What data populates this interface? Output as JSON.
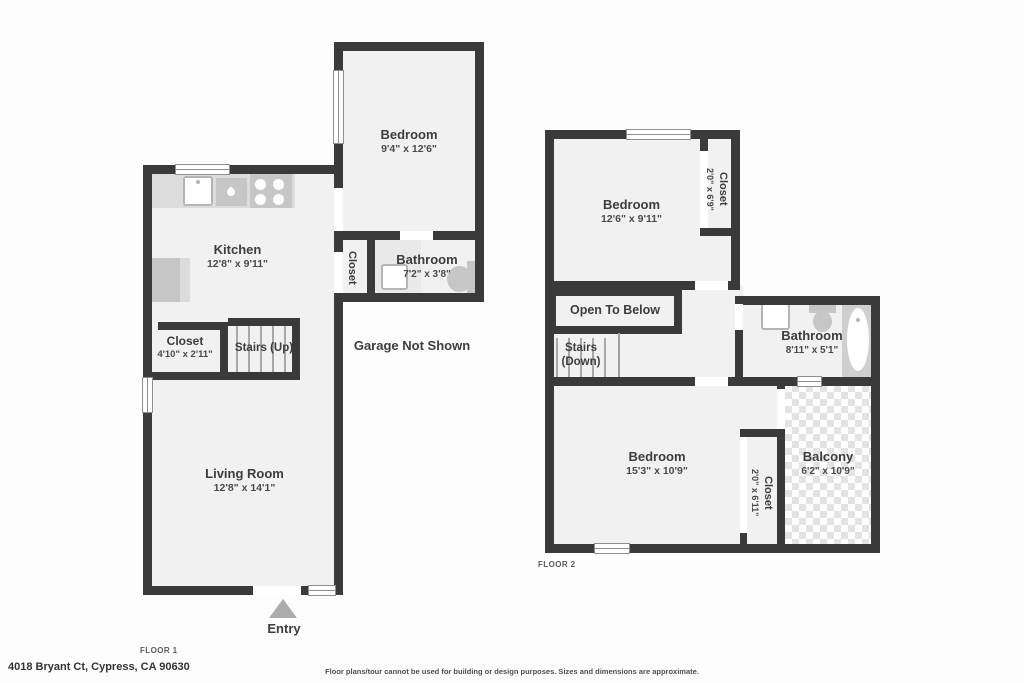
{
  "floor1": {
    "floor_label": "FLOOR 1",
    "bedroom": {
      "name": "Bedroom",
      "dims": "9'4\" x 12'6\""
    },
    "kitchen": {
      "name": "Kitchen",
      "dims": "12'8\" x 9'11\""
    },
    "bathroom": {
      "name": "Bathroom",
      "dims": "7'2\" x 3'8\""
    },
    "hall_closet": {
      "name": "Closet"
    },
    "closet": {
      "name": "Closet",
      "dims": "4'10\" x 2'11\""
    },
    "stairs": {
      "name": "Stairs (Up)"
    },
    "living_room": {
      "name": "Living Room",
      "dims": "12'8\" x 14'1\""
    },
    "garage_note": "Garage Not Shown",
    "entry_label": "Entry"
  },
  "floor2": {
    "floor_label": "FLOOR 2",
    "bedroom_top": {
      "name": "Bedroom",
      "dims": "12'6\" x 9'11\""
    },
    "closet_top": {
      "name": "Closet",
      "dims": "2'0\" x 6'9\""
    },
    "open_to_below": "Open To Below",
    "stairs": {
      "line1": "Stairs",
      "line2": "(Down)"
    },
    "bathroom": {
      "name": "Bathroom",
      "dims": "8'11\" x 5'1\""
    },
    "bedroom_bottom": {
      "name": "Bedroom",
      "dims": "15'3\" x 10'9\""
    },
    "closet_bottom": {
      "name": "Closet",
      "dims": "2'0\" x 6'11\""
    },
    "balcony": {
      "name": "Balcony",
      "dims": "6'2\" x 10'9\""
    }
  },
  "footer": {
    "address": "4018 Bryant Ct, Cypress, CA 90630",
    "disclaimer": "Floor plans/tour cannot be used for building or design purposes. Sizes and dimensions are approximate."
  },
  "colors": {
    "wall": "#3a3a3a",
    "floor": "#f1f1f1",
    "fixture": "#c6c6c6",
    "counter": "#dcdcdc",
    "vanity": "#e9e9e9",
    "tile": "#e3e3e3",
    "arrow": "#ababab",
    "text": "#3d3d3d"
  }
}
